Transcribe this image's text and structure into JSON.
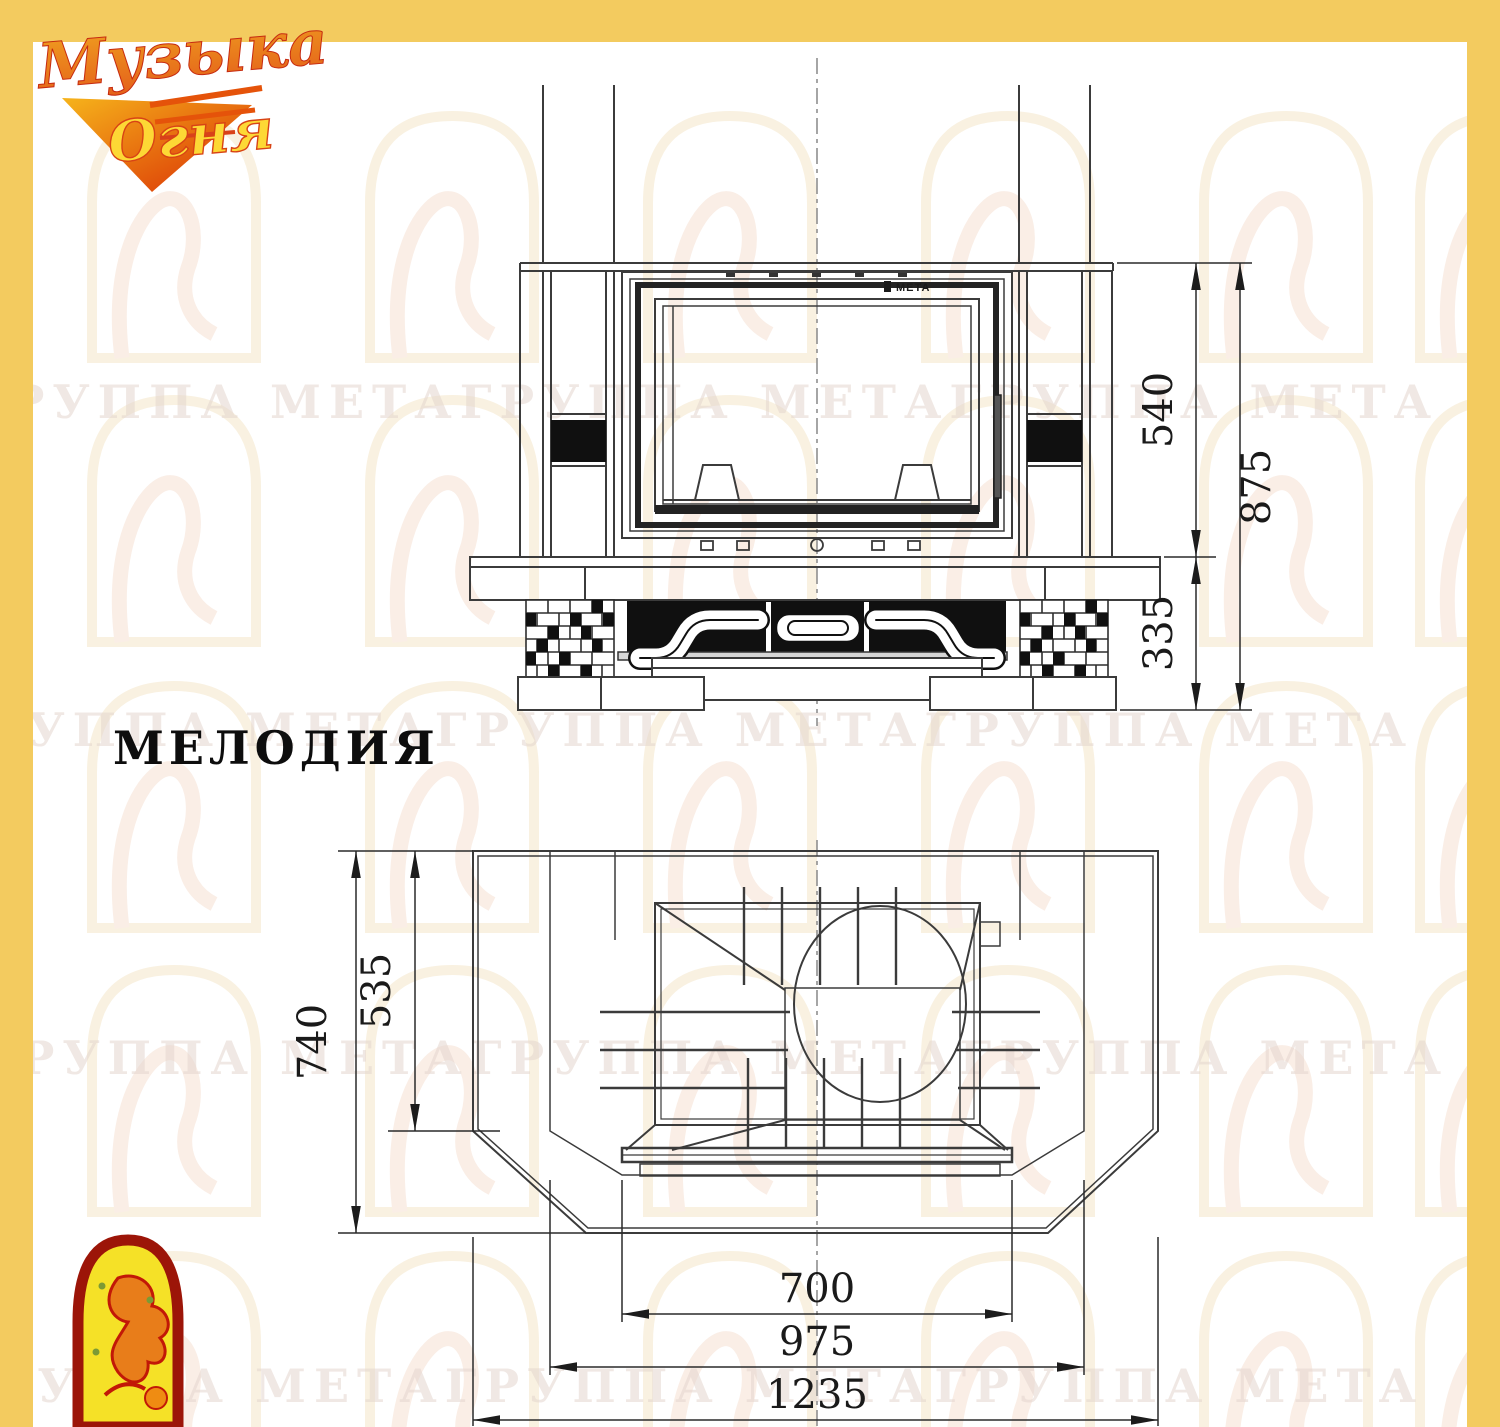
{
  "page": {
    "border_color": "#f3cb5f",
    "bg": "#ffffff"
  },
  "logo": {
    "line1": "Музыка",
    "line2": "Огня"
  },
  "watermark": {
    "text": "ГРУППА МЕТАГРУППА МЕТАГРУППА МЕТА"
  },
  "model": {
    "name": "МЕЛОДИЯ"
  },
  "front_view": {
    "brand_mark": "МЕТА",
    "dim_firebox_height": "540",
    "dim_base_height": "335",
    "dim_total_height": "875"
  },
  "plan_view": {
    "dim_total_depth": "740",
    "dim_inner_depth": "535",
    "dim_firebox_width": "700",
    "dim_front_width": "975",
    "dim_total_width": "1235"
  }
}
